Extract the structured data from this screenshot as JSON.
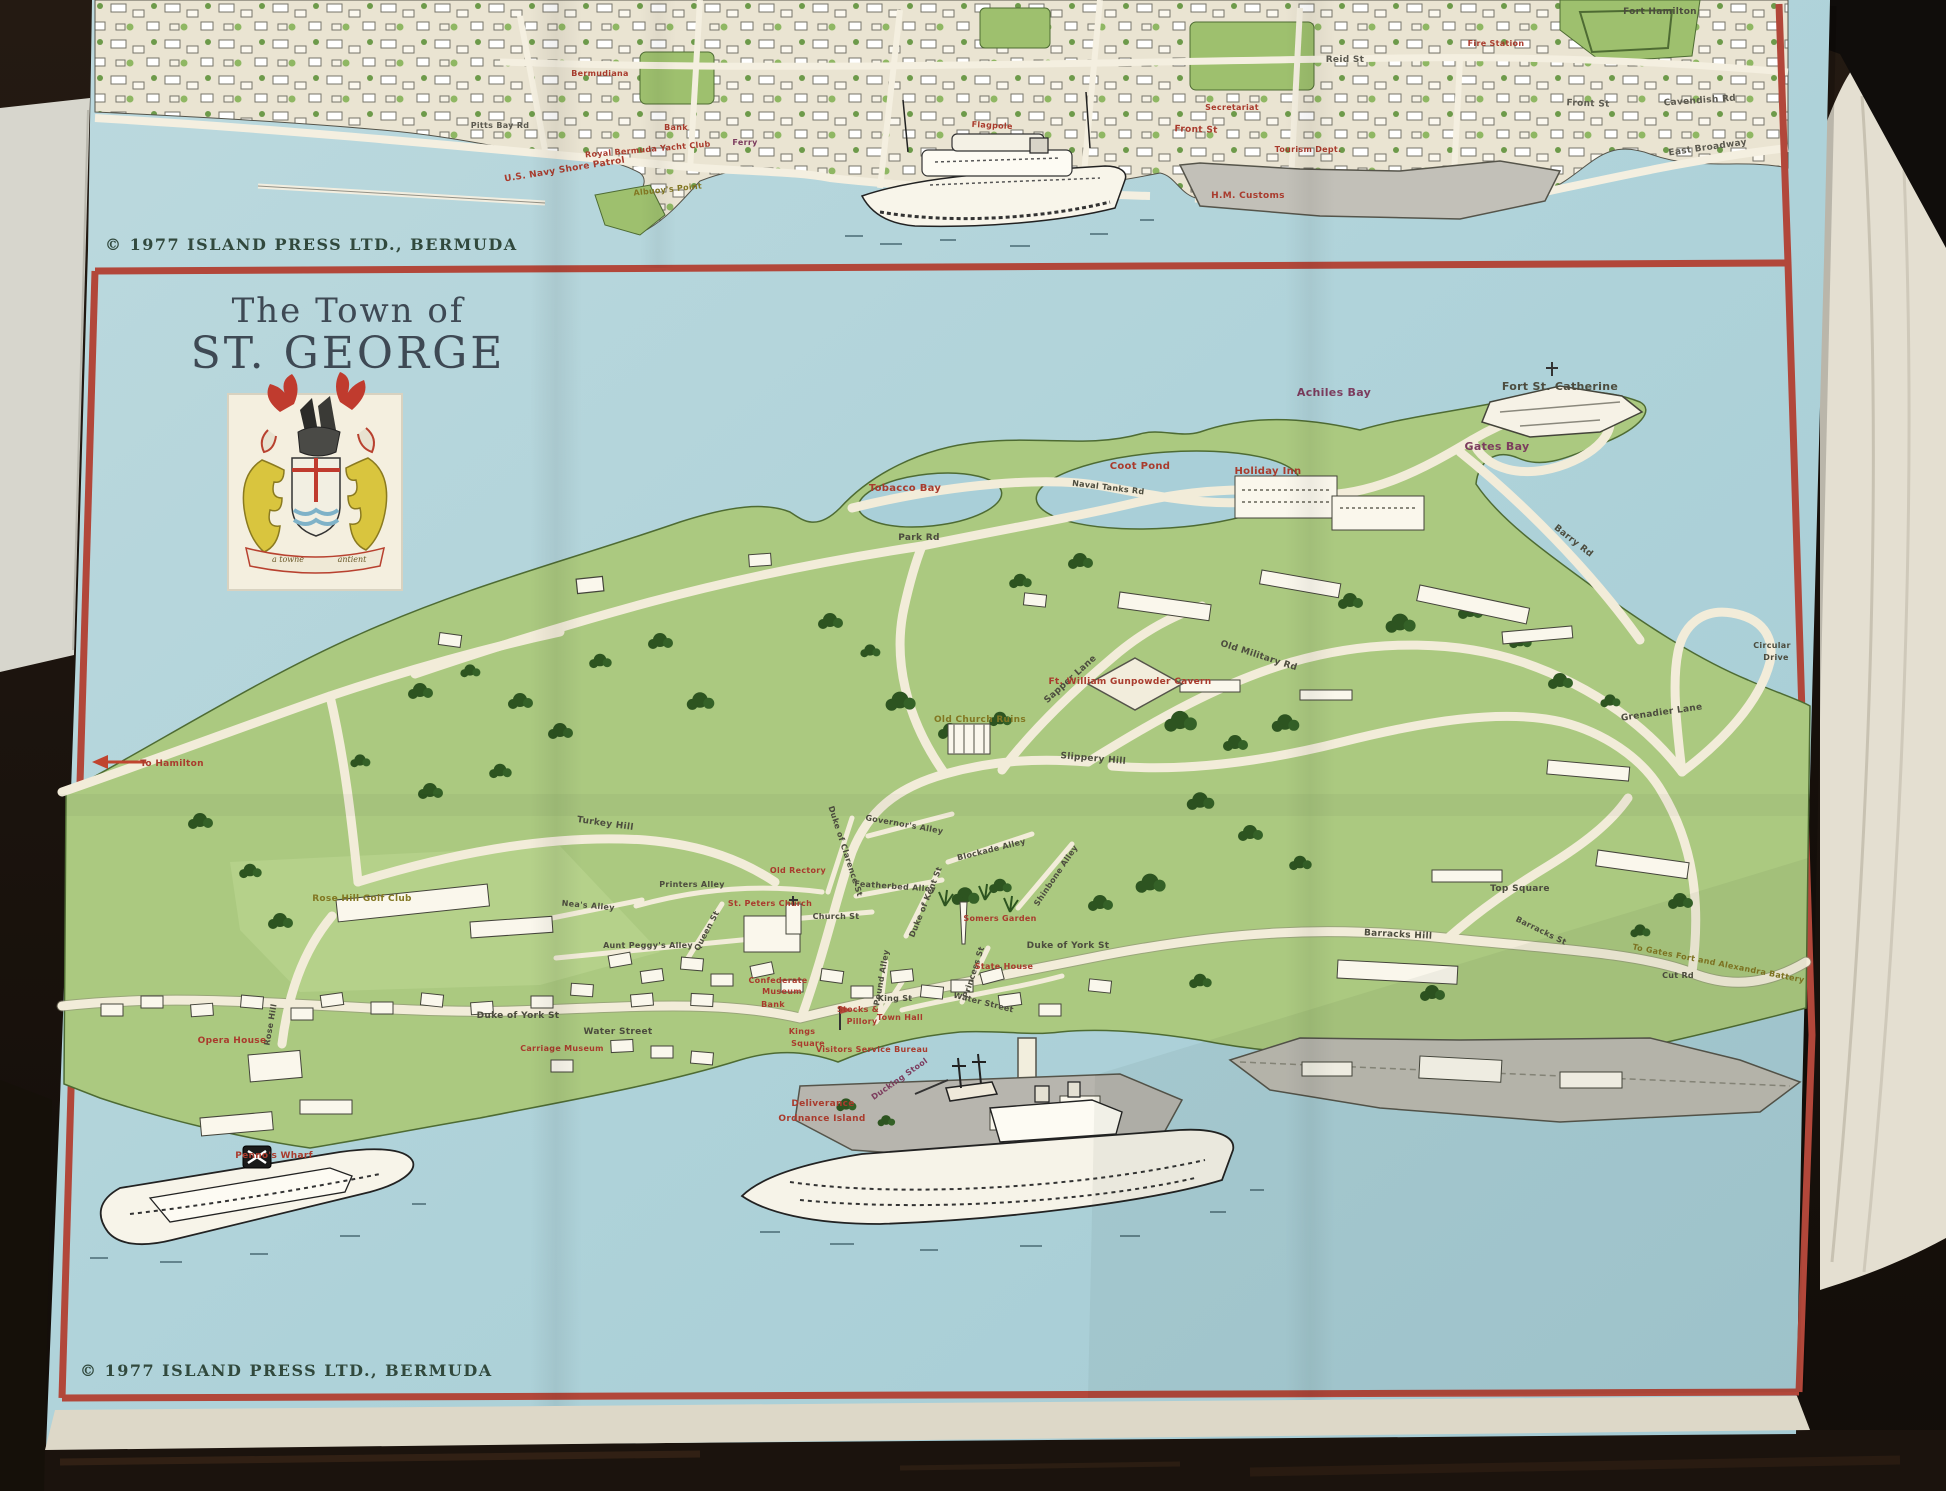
{
  "title": {
    "line1": "The Town of",
    "line2": "ST. GEORGE"
  },
  "crest": {
    "motto_left": "a towne",
    "motto_right": "antient"
  },
  "copyright": {
    "top": "© 1977 ISLAND PRESS LTD., BERMUDA",
    "bottom": "© 1977 ISLAND PRESS LTD., BERMUDA"
  },
  "hamilton": {
    "pitts_bay_rd": "Pitts Bay Rd",
    "bermudiana": "Bermudiana",
    "us_navy": "U.S. Navy Shore Patrol",
    "rbyc": "Royal Bermuda Yacht Club",
    "albuoys_point": "Albuoy's Point",
    "bank": "Bank",
    "ferry": "Ferry",
    "front_st_center": "Front St",
    "flagpole": "Flagpole",
    "front_st_east": "Front St",
    "reid_st": "Reid St",
    "hm_customs": "H.M. Customs",
    "tourism_dept": "Tourism Dept.",
    "fire_station": "Fire Station",
    "secretariat": "Secretariat",
    "cavendish_rd": "Cavendish Rd",
    "east_broadway": "East Broadway",
    "fort_hamilton": "Fort Hamilton"
  },
  "sg": {
    "to_hamilton": "To Hamilton",
    "tobacco_bay": "Tobacco Bay",
    "coot_pond": "Coot Pond",
    "holiday_inn": "Holiday Inn",
    "achiles_bay": "Achiles Bay",
    "fort_st_catherine": "Fort  St. Catherine",
    "gates_bay": "Gates Bay",
    "park_rd": "Park Rd",
    "naval_tanks_rd": "Naval Tanks Rd",
    "barry_rd": "Barry Rd",
    "circular": "Circular",
    "drive": "Drive",
    "grenadier_lane": "Grenadier Lane",
    "old_military_rd": "Old Military Rd",
    "sapper_lane": "Sapper Lane",
    "gunpowder_cavern": "Ft. William Gunpowder Cavern",
    "old_church_ruins": "Old Church Ruins",
    "slippery_hill": "Slippery Hill",
    "turkey_hill": "Turkey Hill",
    "printers_alley": "Printers Alley",
    "neas_alley": "Nea's Alley",
    "aunt_peggys_alley": "Aunt Peggy's Alley",
    "old_rectory": "Old Rectory",
    "st_peters_church": "St. Peters Church",
    "church_st": "Church St",
    "duke_of_clarence_st": "Duke of Clarence St",
    "featherbed_alley": "Featherbed Alley",
    "governors_alley": "Governor's Alley",
    "queen_st": "Queen St",
    "blockade_alley": "Blockade Alley",
    "shinbone_alley": "Shinbone Alley",
    "somers_garden": "Somers Garden",
    "duke_of_kent_st": "Duke of Kent St",
    "duke_of_york_st_e": "Duke of York St",
    "barracks_hill": "Barracks Hill",
    "top_square": "Top Square",
    "barracks_st": "Barracks St",
    "gates_fort": "To Gates Fort and Alexandra Battery",
    "cut_rd": "Cut Rd",
    "rose_hill_golf_club": "Rose Hill Golf Club",
    "rose_hill": "Rose Hill",
    "opera_house": "Opera House",
    "pennos_wharf": "Penno's Wharf",
    "duke_of_york_st_w": "Duke of York St",
    "water_street_w": "Water Street",
    "water_street_e": "Water Street",
    "kings": "Kings",
    "square": "Square",
    "stocks": "Stocks &",
    "pillory": "Pillory",
    "town_hall": "Town Hall",
    "king_st": "King St",
    "pound_alley": "Pound Alley",
    "princess_st": "Princess St",
    "state_house": "State House",
    "confederate": "Confederate",
    "museum": "Museum",
    "bank": "Bank",
    "visitors_service_bureau": "Visitors Service Bureau",
    "carriage_museum": "Carriage Museum",
    "ducking_stool": "Ducking Stool",
    "deliverance": "Deliverance",
    "ordnance_island": "Ordnance Island"
  }
}
